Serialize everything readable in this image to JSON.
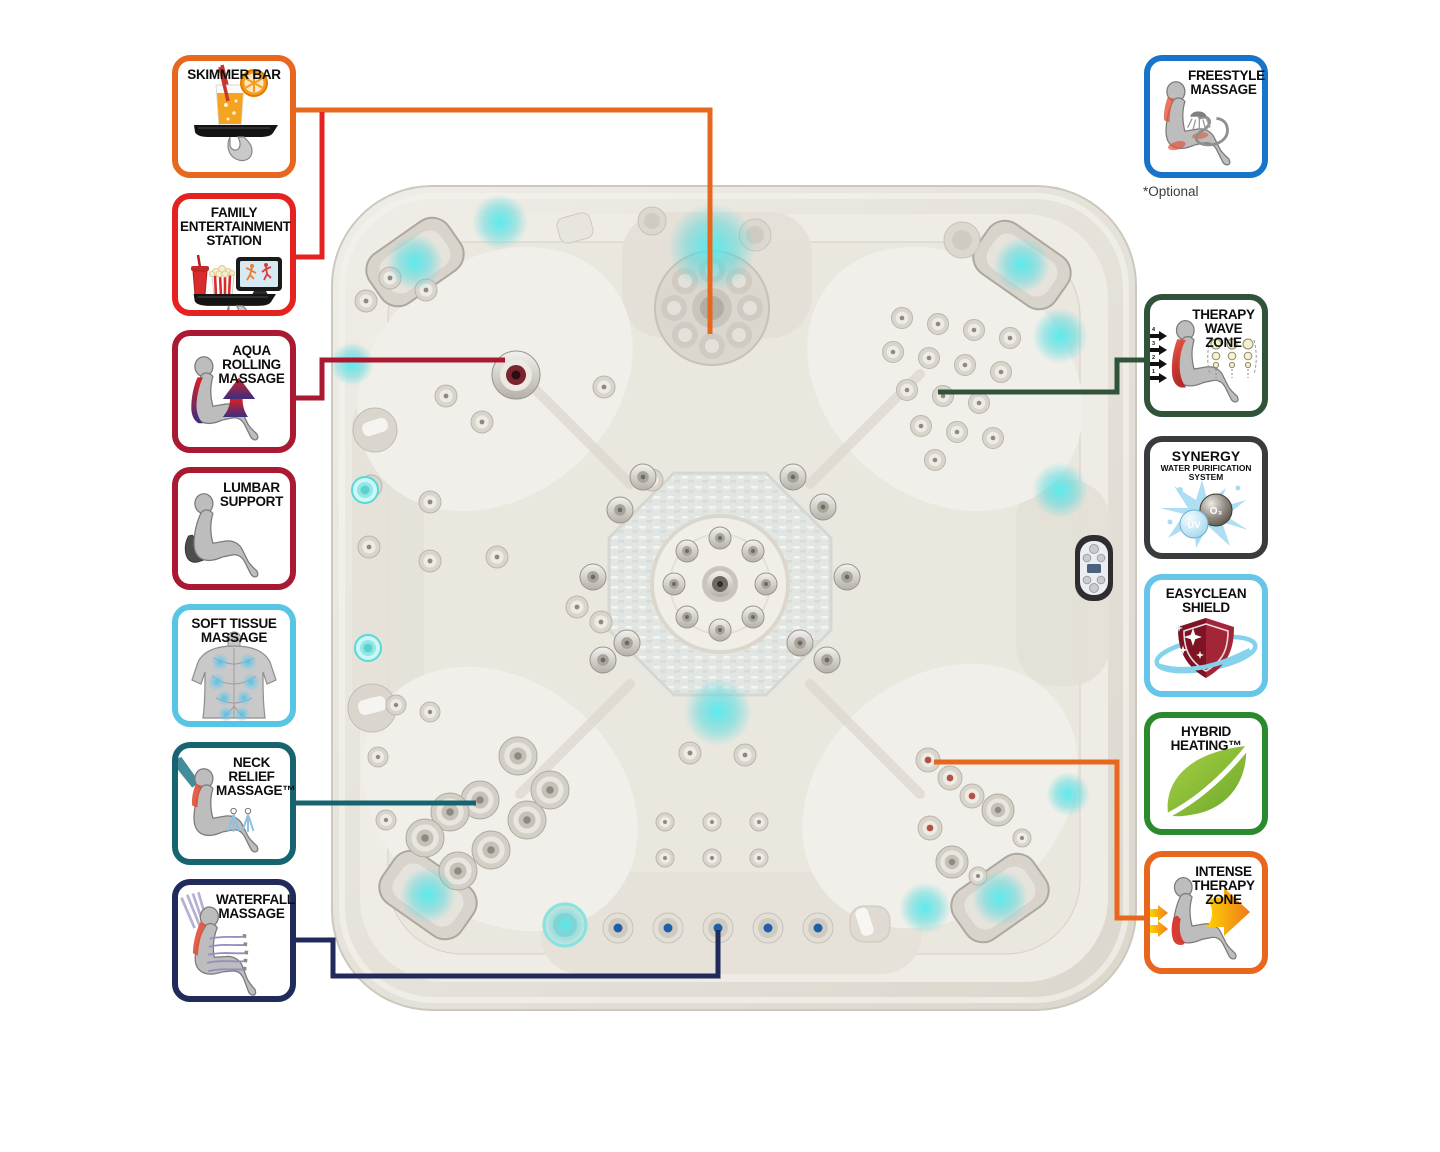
{
  "diagram": {
    "subject": "hot tub top view feature diagram",
    "led_color": "#4FE3E7",
    "shell_color": "#E8E4DC"
  },
  "callouts_left": [
    {
      "label": "SKIMMER BAR",
      "color": "#E8671F"
    },
    {
      "label": "FAMILY ENTERTAINMENT STATION",
      "color": "#E42320"
    },
    {
      "label": "AQUA ROLLING MASSAGE",
      "color": "#A91932"
    },
    {
      "label": "LUMBAR SUPPORT",
      "color": "#A91932"
    },
    {
      "label": "SOFT TISSUE MASSAGE",
      "color": "#59C5E5"
    },
    {
      "label": "NECK RELIEF MASSAGE™",
      "color": "#156470"
    },
    {
      "label": "WATERFALL MASSAGE",
      "color": "#202A5B"
    }
  ],
  "callouts_right": [
    {
      "label": "FREESTYLE MASSAGE",
      "color": "#1874C8",
      "note": "*Optional"
    },
    {
      "label": "THERAPY WAVE ZONE",
      "color": "#30533A",
      "arrow_numbers": [
        "4",
        "3",
        "2",
        "1"
      ]
    },
    {
      "label": "SYNERGY",
      "sublabel": "WATER PURIFICATION SYSTEM",
      "color": "#3A3B3D",
      "uv_label": "UV",
      "o3_label": "O₃"
    },
    {
      "label": "EASYCLEAN SHIELD",
      "color": "#66C5E8"
    },
    {
      "label": "HYBRID HEATING™",
      "color": "#2C8A2E"
    },
    {
      "label": "INTENSE THERAPY ZONE",
      "color": "#E8671F"
    }
  ]
}
